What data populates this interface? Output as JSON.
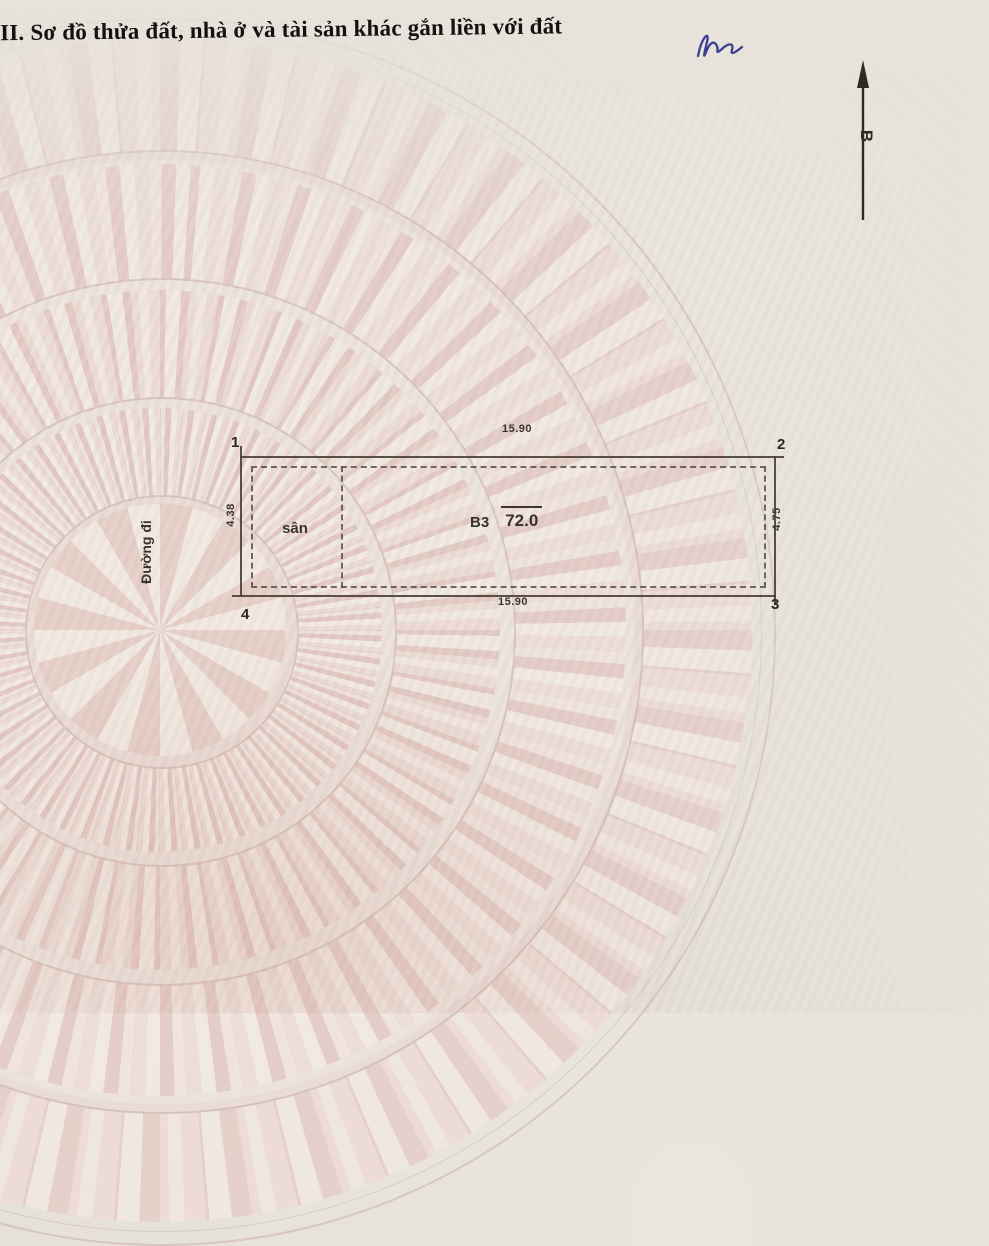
{
  "header": {
    "section_title": "III. Sơ đồ thửa đất, nhà ở và tài sản khác gắn liền với đất",
    "signature_mark": "handwritten blue-ink initials"
  },
  "compass": {
    "north_label": "B"
  },
  "diagram": {
    "road_label": "Đường đi",
    "corners": [
      "1",
      "2",
      "3",
      "4"
    ],
    "dimensions": {
      "top": "15.90",
      "bottom": "15.90",
      "left": "4.38",
      "right": "4.75"
    },
    "yard_label": "sân",
    "parcel_label": "B3",
    "parcel_area": "72.0"
  },
  "colors": {
    "paper": "#e6e1da",
    "ink": "#15110d",
    "boundary_line": "#4a3f34",
    "watermark_pink": "#e5cfca",
    "watermark_light": "#f0e9e1",
    "signature_blue": "#3c3f8f"
  }
}
